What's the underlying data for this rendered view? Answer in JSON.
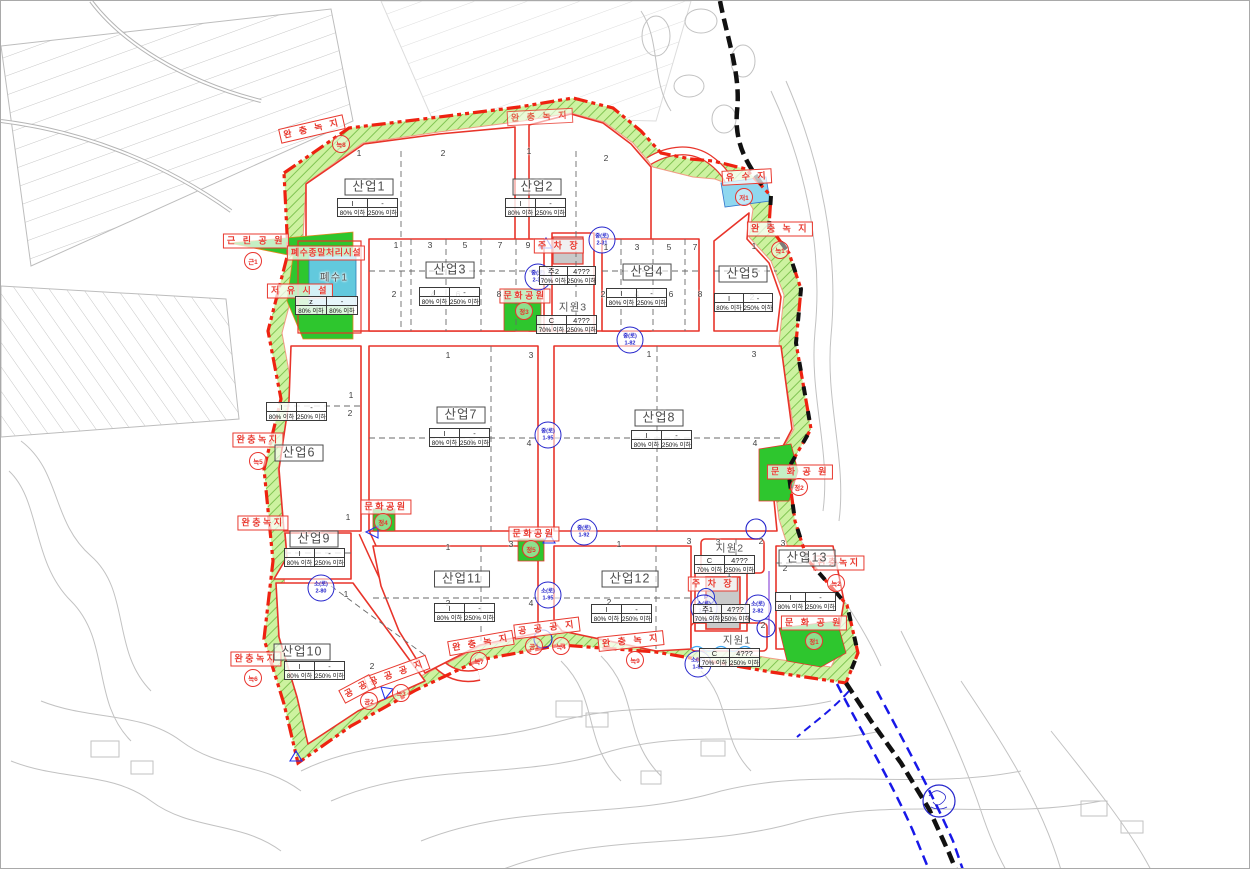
{
  "map_type": "industrial-complex-land-use-plan",
  "colors": {
    "boundary_red": "#ee2211",
    "road_red": "#e8342a",
    "buffer_green_fill": "#cdf2a0",
    "buffer_hatch": "#78bf4a",
    "park_green": "#2ec62e",
    "water_cyan": "#62c9dd",
    "parking_gray": "#c9c9c9",
    "road_bubble_blue": "#2525cc",
    "municipal_boundary_black": "#111111",
    "river_blue": "#1818e8",
    "terrain_gray": "#c2c2c2"
  },
  "lots": [
    {
      "id": "sanup1",
      "name": "산업1",
      "boxed": true,
      "nx": 368,
      "ny": 186,
      "tx": 368,
      "ty": 198,
      "tw": 62,
      "header": [
        "I",
        "-"
      ],
      "values": [
        "80% 이하",
        "250% 이하"
      ]
    },
    {
      "id": "sanup2",
      "name": "산업2",
      "boxed": true,
      "nx": 536,
      "ny": 186,
      "tx": 536,
      "ty": 198,
      "tw": 62,
      "header": [
        "I",
        "-"
      ],
      "values": [
        "80% 이하",
        "250% 이하"
      ]
    },
    {
      "id": "sanup3",
      "name": "산업3",
      "boxed": true,
      "nx": 449,
      "ny": 269,
      "tx": 450,
      "ty": 287,
      "tw": 62,
      "header": [
        "I",
        "-"
      ],
      "values": [
        "80% 이하",
        "250% 이하"
      ]
    },
    {
      "id": "sanup4",
      "name": "산업4",
      "boxed": true,
      "nx": 646,
      "ny": 271,
      "tx": 637,
      "ty": 288,
      "tw": 62,
      "header": [
        "I",
        "-"
      ],
      "values": [
        "80% 이하",
        "250% 이하"
      ]
    },
    {
      "id": "sanup5",
      "name": "산업5",
      "boxed": true,
      "nx": 742,
      "ny": 273,
      "tx": 744,
      "ty": 293,
      "tw": 60,
      "header": [
        "I",
        "-"
      ],
      "values": [
        "80% 이하",
        "250% 이하"
      ]
    },
    {
      "id": "sanup6",
      "name": "산업6",
      "boxed": true,
      "nx": 298,
      "ny": 452,
      "tx": 297,
      "ty": 402,
      "tw": 62,
      "header": [
        "I",
        "-"
      ],
      "values": [
        "80% 이하",
        "250% 이하"
      ]
    },
    {
      "id": "sanup7",
      "name": "산업7",
      "boxed": true,
      "nx": 460,
      "ny": 414,
      "tx": 460,
      "ty": 428,
      "tw": 62,
      "header": [
        "I",
        "-"
      ],
      "values": [
        "80% 이하",
        "250% 이하"
      ]
    },
    {
      "id": "sanup8",
      "name": "산업8",
      "boxed": true,
      "nx": 658,
      "ny": 417,
      "tx": 662,
      "ty": 430,
      "tw": 62,
      "header": [
        "I",
        "-"
      ],
      "values": [
        "80% 이하",
        "250% 이하"
      ]
    },
    {
      "id": "sanup9",
      "name": "산업9",
      "boxed": true,
      "nx": 313,
      "ny": 538,
      "tx": 315,
      "ty": 548,
      "tw": 62,
      "header": [
        "I",
        "-"
      ],
      "values": [
        "80% 이하",
        "250% 이하"
      ]
    },
    {
      "id": "sanup10",
      "name": "산업10",
      "boxed": true,
      "nx": 301,
      "ny": 651,
      "tx": 315,
      "ty": 661,
      "tw": 62,
      "header": [
        "I",
        "-"
      ],
      "values": [
        "80% 이하",
        "250% 이하"
      ]
    },
    {
      "id": "sanup11",
      "name": "산업11",
      "boxed": true,
      "nx": 461,
      "ny": 578,
      "tx": 465,
      "ty": 603,
      "tw": 62,
      "header": [
        "I",
        "-"
      ],
      "values": [
        "80% 이하",
        "250% 이하"
      ]
    },
    {
      "id": "sanup12",
      "name": "산업12",
      "boxed": true,
      "nx": 629,
      "ny": 578,
      "tx": 622,
      "ty": 604,
      "tw": 62,
      "header": [
        "I",
        "-"
      ],
      "values": [
        "80% 이하",
        "250% 이하"
      ]
    },
    {
      "id": "sanup13",
      "name": "산업13",
      "boxed": true,
      "nx": 806,
      "ny": 557,
      "tx": 806,
      "ty": 592,
      "tw": 62,
      "header": [
        "I",
        "-"
      ],
      "values": [
        "80% 이하",
        "250% 이하"
      ]
    },
    {
      "id": "jiwon3",
      "name": "지원3",
      "boxed": false,
      "nx": 572,
      "ny": 306,
      "tx": 567,
      "ty": 315,
      "tw": 62,
      "header": [
        "C",
        "4???"
      ],
      "values": [
        "70% 이하",
        "250% 이하"
      ]
    },
    {
      "id": "jiwon2",
      "name": "지원2",
      "boxed": false,
      "nx": 729,
      "ny": 547,
      "tx": 725,
      "ty": 555,
      "tw": 62,
      "header": [
        "C",
        "4???"
      ],
      "values": [
        "70% 이하",
        "250% 이하"
      ]
    },
    {
      "id": "jiwon1",
      "name": "지원1",
      "boxed": false,
      "nx": 736,
      "ny": 639,
      "tx": 730,
      "ty": 648,
      "tw": 62,
      "header": [
        "C",
        "4???"
      ],
      "values": [
        "70% 이하",
        "250% 이하"
      ]
    },
    {
      "id": "pyesu1",
      "name": "폐수1",
      "boxed": false,
      "nx": 333,
      "ny": 276,
      "tx": 327,
      "ty": 296,
      "tw": 64,
      "header": [
        "z",
        "-"
      ],
      "values": [
        "80% 이하",
        "80% 이하"
      ]
    },
    {
      "id": "ju2",
      "name": null,
      "tx": 568,
      "ty": 266,
      "tw": 58,
      "header": [
        "주2",
        "4???"
      ],
      "values": [
        "70% 이하",
        "250% 이하"
      ]
    },
    {
      "id": "ju1",
      "name": null,
      "tx": 722,
      "ty": 604,
      "tw": 58,
      "header": [
        "주1",
        "4???"
      ],
      "values": [
        "70% 이하",
        "250% 이하"
      ]
    }
  ],
  "red_labels": [
    {
      "id": "wanchung-1",
      "text": "완 충 녹 지",
      "x": 311,
      "y": 128,
      "rot": -13
    },
    {
      "id": "wanchung-2",
      "text": "완 충 녹 지",
      "x": 539,
      "y": 116,
      "rot": -3,
      "op": 0.8
    },
    {
      "id": "wanchung-3",
      "text": "완 충 녹 지",
      "x": 779,
      "y": 228,
      "rot": 0
    },
    {
      "id": "wanchung-4",
      "text": "완충녹지",
      "x": 257,
      "y": 439,
      "rot": 0
    },
    {
      "id": "wanchung-5",
      "text": "완충녹지",
      "x": 262,
      "y": 522,
      "rot": 0
    },
    {
      "id": "wanchung-6",
      "text": "완충녹지",
      "x": 255,
      "y": 658,
      "rot": 0
    },
    {
      "id": "wanchung-7",
      "text": "완 충 녹 지",
      "x": 480,
      "y": 642,
      "rot": -10
    },
    {
      "id": "wanchung-8",
      "text": "완 충 녹 지",
      "x": 630,
      "y": 640,
      "rot": -6
    },
    {
      "id": "wanchung-9",
      "text": "완충녹지",
      "x": 838,
      "y": 562,
      "rot": 0
    },
    {
      "id": "geunrin-park",
      "text": "근 린 공 원",
      "x": 255,
      "y": 240,
      "rot": 0
    },
    {
      "id": "pyesu-facility",
      "text": "폐수종말처리시설",
      "x": 325,
      "y": 252,
      "rot": 0
    },
    {
      "id": "jeoyu-facility",
      "text": "저 유 시 설",
      "x": 299,
      "y": 290,
      "rot": 0
    },
    {
      "id": "munhwa-park-a",
      "text": "문화공원",
      "x": 524,
      "y": 295,
      "rot": 0
    },
    {
      "id": "munhwa-park-b",
      "text": "문화공원",
      "x": 385,
      "y": 506,
      "rot": 0
    },
    {
      "id": "munhwa-park-c",
      "text": "문화공원",
      "x": 533,
      "y": 533,
      "rot": 0
    },
    {
      "id": "munhwa-park-d",
      "text": "문 화 공 원",
      "x": 799,
      "y": 471,
      "rot": 0
    },
    {
      "id": "munhwa-park-e",
      "text": "문 화 공 원",
      "x": 813,
      "y": 622,
      "rot": 0
    },
    {
      "id": "parking-a",
      "text": "주 차 장",
      "x": 558,
      "y": 245,
      "rot": 0
    },
    {
      "id": "parking-b",
      "text": "주 차 장",
      "x": 712,
      "y": 583,
      "rot": 0
    },
    {
      "id": "yusuji",
      "text": "유 수 지",
      "x": 746,
      "y": 176,
      "rot": -3
    },
    {
      "id": "gonggong-a",
      "text": "공 공 공 지",
      "x": 546,
      "y": 627,
      "rot": -7
    },
    {
      "id": "gonggong-b",
      "text": "공 공 공 지",
      "x": 396,
      "y": 672,
      "rot": -20
    },
    {
      "id": "gonggong-c",
      "text": "공 공",
      "x": 356,
      "y": 688,
      "rot": -28
    }
  ],
  "markers": [
    {
      "t": "녹8",
      "x": 340,
      "y": 143
    },
    {
      "t": "녹1",
      "x": 779,
      "y": 249
    },
    {
      "t": "근1",
      "x": 252,
      "y": 260
    },
    {
      "t": "저1",
      "x": 743,
      "y": 196
    },
    {
      "t": "정3",
      "x": 523,
      "y": 310
    },
    {
      "t": "녹5",
      "x": 257,
      "y": 460
    },
    {
      "t": "정4",
      "x": 382,
      "y": 521
    },
    {
      "t": "정2",
      "x": 798,
      "y": 486
    },
    {
      "t": "정5",
      "x": 530,
      "y": 548
    },
    {
      "t": "녹2",
      "x": 835,
      "y": 582
    },
    {
      "t": "정1",
      "x": 813,
      "y": 640
    },
    {
      "t": "녹6",
      "x": 252,
      "y": 677
    },
    {
      "t": "공2",
      "x": 368,
      "y": 700
    },
    {
      "t": "녹3",
      "x": 400,
      "y": 692
    },
    {
      "t": "녹7",
      "x": 478,
      "y": 660
    },
    {
      "t": "공1",
      "x": 533,
      "y": 645
    },
    {
      "t": "녹4",
      "x": 560,
      "y": 645
    },
    {
      "t": "녹9",
      "x": 634,
      "y": 659
    },
    {
      "t": "P",
      "x": 705,
      "y": 596,
      "blue": true
    }
  ],
  "bubbles": [
    {
      "l1": "중(로)",
      "l2": "2-31",
      "x": 601,
      "y": 239
    },
    {
      "l1": "중(로)",
      "l2": "1-82",
      "x": 629,
      "y": 339
    },
    {
      "l1": "중(로)",
      "l2": "1-95",
      "x": 547,
      "y": 434
    },
    {
      "l1": "중(로)",
      "l2": "1-92",
      "x": 583,
      "y": 531
    },
    {
      "l1": "소(로)",
      "l2": "1-95",
      "x": 547,
      "y": 594
    },
    {
      "l1": "소(로)",
      "l2": "2-80",
      "x": 320,
      "y": 587
    },
    {
      "l1": "소(로)",
      "l2": "1-82",
      "x": 697,
      "y": 663
    },
    {
      "l1": "소(로)",
      "l2": "2-81",
      "x": 703,
      "y": 607
    },
    {
      "l1": "소(로)",
      "l2": "2-82",
      "x": 757,
      "y": 607
    },
    {
      "l1": "중(로)",
      "l2": "2-31",
      "x": 537,
      "y": 276
    }
  ],
  "parcel_numbers": [
    {
      "n": "1",
      "x": 358,
      "y": 152
    },
    {
      "n": "2",
      "x": 442,
      "y": 152
    },
    {
      "n": "1",
      "x": 528,
      "y": 150
    },
    {
      "n": "2",
      "x": 605,
      "y": 157
    },
    {
      "n": "1",
      "x": 395,
      "y": 244
    },
    {
      "n": "3",
      "x": 429,
      "y": 244
    },
    {
      "n": "5",
      "x": 464,
      "y": 244
    },
    {
      "n": "7",
      "x": 499,
      "y": 244
    },
    {
      "n": "9",
      "x": 527,
      "y": 244
    },
    {
      "n": "2",
      "x": 393,
      "y": 293
    },
    {
      "n": "4",
      "x": 432,
      "y": 293
    },
    {
      "n": "6",
      "x": 457,
      "y": 293
    },
    {
      "n": "8",
      "x": 498,
      "y": 293
    },
    {
      "n": "1",
      "x": 605,
      "y": 246
    },
    {
      "n": "3",
      "x": 636,
      "y": 246
    },
    {
      "n": "5",
      "x": 668,
      "y": 246
    },
    {
      "n": "7",
      "x": 694,
      "y": 246
    },
    {
      "n": "2",
      "x": 602,
      "y": 293
    },
    {
      "n": "4",
      "x": 636,
      "y": 293
    },
    {
      "n": "6",
      "x": 670,
      "y": 293
    },
    {
      "n": "8",
      "x": 699,
      "y": 293
    },
    {
      "n": "1",
      "x": 753,
      "y": 245
    },
    {
      "n": "2",
      "x": 751,
      "y": 296
    },
    {
      "n": "1",
      "x": 350,
      "y": 394
    },
    {
      "n": "2",
      "x": 349,
      "y": 412
    },
    {
      "n": "1",
      "x": 447,
      "y": 354
    },
    {
      "n": "3",
      "x": 530,
      "y": 354
    },
    {
      "n": "2",
      "x": 470,
      "y": 441
    },
    {
      "n": "4",
      "x": 528,
      "y": 442
    },
    {
      "n": "1",
      "x": 648,
      "y": 353
    },
    {
      "n": "3",
      "x": 753,
      "y": 353
    },
    {
      "n": "2",
      "x": 655,
      "y": 442
    },
    {
      "n": "4",
      "x": 754,
      "y": 442
    },
    {
      "n": "1",
      "x": 347,
      "y": 516
    },
    {
      "n": "1",
      "x": 345,
      "y": 593
    },
    {
      "n": "2",
      "x": 371,
      "y": 665
    },
    {
      "n": "1",
      "x": 447,
      "y": 546
    },
    {
      "n": "3",
      "x": 510,
      "y": 543
    },
    {
      "n": "2",
      "x": 447,
      "y": 602
    },
    {
      "n": "4",
      "x": 530,
      "y": 602
    },
    {
      "n": "1",
      "x": 618,
      "y": 543
    },
    {
      "n": "3",
      "x": 688,
      "y": 540
    },
    {
      "n": "2",
      "x": 608,
      "y": 601
    },
    {
      "n": "3",
      "x": 782,
      "y": 542
    },
    {
      "n": "2",
      "x": 784,
      "y": 567
    },
    {
      "n": "3",
      "x": 717,
      "y": 541
    },
    {
      "n": "2",
      "x": 760,
      "y": 540
    },
    {
      "n": "1",
      "x": 728,
      "y": 573
    },
    {
      "n": "2",
      "x": 762,
      "y": 624
    }
  ]
}
